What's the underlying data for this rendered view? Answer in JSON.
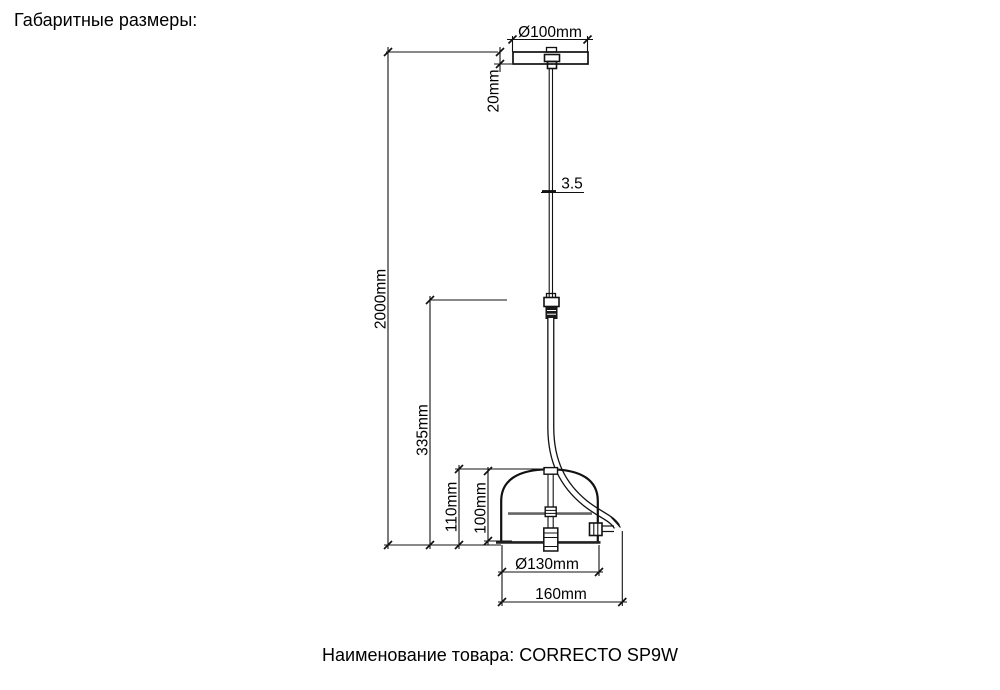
{
  "header": {
    "title": "Габаритные размеры:"
  },
  "footer": {
    "product_line": "Наименование товара: CORRECTO SP9W",
    "product_name": "CORRECTO SP9W"
  },
  "dimensions": {
    "canopy_diameter": "Ø100mm",
    "canopy_height": "20mm",
    "cable_diameter": "3.5",
    "overall_drop": "2000mm",
    "stem_length": "335mm",
    "shade_height_outer": "110mm",
    "shade_height_inner": "100mm",
    "shade_diameter": "Ø130mm",
    "fixture_width": "160mm"
  },
  "colors": {
    "line": "#111111",
    "plate_gray": "#666666",
    "background": "#ffffff"
  }
}
